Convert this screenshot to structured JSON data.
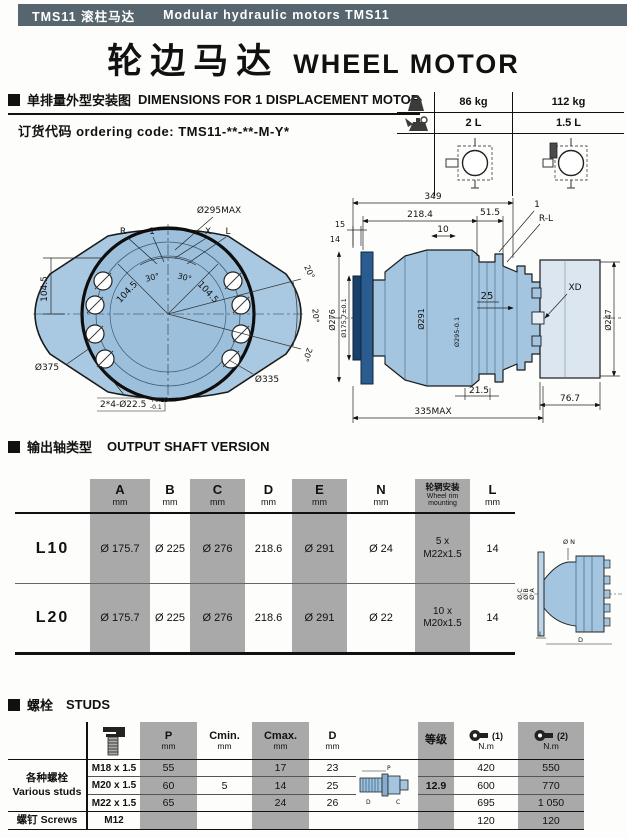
{
  "header_bar": {
    "left": "TMS11 滚柱马达",
    "right": "Modular hydraulic motors TMS11"
  },
  "title": {
    "cn": "轮边马达",
    "en": "WHEEL MOTOR"
  },
  "dim_section": {
    "heading_cn": "单排量外型安装图",
    "heading_en": "DIMENSIONS FOR 1 DISPLACEMENT MOTOR",
    "ordering": "订货代码 ordering code: TMS11-**-**-M-Y*",
    "spec": {
      "weight_1": "86 kg",
      "weight_2": "112 kg",
      "oil_1": "2 L",
      "oil_2": "1.5 L"
    }
  },
  "front_view": {
    "r": "R",
    "one": "1",
    "x": "X",
    "l": "L",
    "d295": "Ø295MAX",
    "d375": "Ø375",
    "d335": "Ø335",
    "bolt": "2*4-Ø22.5",
    "bolt_tol_up": "+0.25",
    "bolt_tol_dn": "-0.1",
    "h104": "104.5",
    "h104b": "104.5",
    "h104c": "104.5",
    "a30a": "30°",
    "a30b": "30°",
    "a20a": "20°",
    "a20b": "20°",
    "a20c": "20°"
  },
  "side_view": {
    "d349": "349",
    "d218": "218.4",
    "d51": "51.5",
    "d10": "10",
    "d15": "15",
    "d14": "14",
    "one": "1",
    "rl": "R-L",
    "d25": "25",
    "xd": "XD",
    "d276": "Ø276",
    "d175": "Ø175.7±0.1",
    "d291": "Ø291",
    "d295t": "Ø295-0.1",
    "d247": "Ø247",
    "d215": "21.5",
    "d767": "76.7",
    "d335max": "335MAX"
  },
  "shaft_section": {
    "heading_cn": "输出轴类型",
    "heading_en": "OUTPUT SHAFT VERSION",
    "headers": {
      "a": "A",
      "b": "B",
      "c": "C",
      "d": "D",
      "e": "E",
      "n": "N",
      "l": "L",
      "mm": "mm",
      "rim_cn": "轮辋安装",
      "rim_en1": "Wheel rim",
      "rim_en2": "mounting"
    },
    "rows": [
      {
        "label": "L10",
        "a": "Ø 175.7",
        "b": "Ø 225",
        "c": "Ø 276",
        "d": "218.6",
        "e": "Ø 291",
        "n": "Ø 24",
        "rim1": "5 x",
        "rim2": "M22x1.5",
        "l": "14"
      },
      {
        "label": "L20",
        "a": "Ø 175.7",
        "b": "Ø 225",
        "c": "Ø 276",
        "d": "218.6",
        "e": "Ø 291",
        "n": "Ø 22",
        "rim1": "10 x",
        "rim2": "M20x1.5",
        "l": "14"
      }
    ],
    "drawing": {
      "dn": "Ø N",
      "dc": "Ø C",
      "db": "Ø B",
      "da": "Ø A",
      "l": "L",
      "d": "D"
    }
  },
  "studs_section": {
    "heading_cn": "螺栓",
    "heading_en": "STUDS",
    "headers": {
      "p": "P",
      "cmin": "Cmin.",
      "cmax": "Cmax.",
      "d": "D",
      "mm": "mm",
      "grade": "等级",
      "t1": "(1)",
      "t2": "(2)",
      "nm": "N.m"
    },
    "groups": {
      "g1_cn": "各种螺栓",
      "g1_en": "Various studs",
      "g2_cn": "螺钉",
      "g2_en": "Screws"
    },
    "cmin_value": "5",
    "grade_value": "12.9",
    "rows": [
      {
        "thread": "M18 x 1.5",
        "p": "55",
        "cmax": "17",
        "d": "23",
        "t1": "420",
        "t2": "550"
      },
      {
        "thread": "M20 x 1.5",
        "p": "60",
        "cmax": "14",
        "d": "25",
        "t1": "600",
        "t2": "770"
      },
      {
        "thread": "M22 x 1.5",
        "p": "65",
        "cmax": "24",
        "d": "26",
        "t1": "695",
        "t2": "1 050"
      },
      {
        "thread": "M12",
        "p": "",
        "cmax": "",
        "d": "",
        "t1": "120",
        "t2": "120"
      }
    ],
    "drawing": {
      "p": "P",
      "d": "D",
      "c": "C"
    }
  }
}
